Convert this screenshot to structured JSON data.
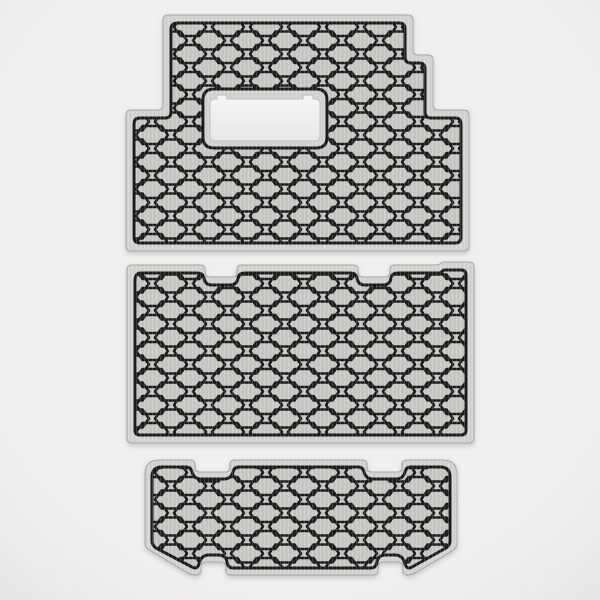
{
  "scene": {
    "type": "3d-product-render",
    "subject": "Three-piece honeycomb cargo mat liner set on a plain studio background",
    "pattern": "hexagon-honeycomb-emboss",
    "pieces": [
      {
        "name": "upper-cargo-mat",
        "description": "Large mat, stepped outline on both sides, rectangular pass-through cutout near top center"
      },
      {
        "name": "middle-cargo-mat",
        "description": "Rectangular mat with two latch notches on the top edge and a small step near the top-right corner"
      },
      {
        "name": "lower-cargo-mat",
        "description": "Short mat with two notches on the top edge, two notches on the bottom edge and chamfered lower corners"
      }
    ]
  },
  "colors": {
    "background": "#f0efed",
    "vignette": "#e7e6e4",
    "rim": "#d5d3cf",
    "rim_edge": "#a8a6a2",
    "surface": "#c9c7c2",
    "hex_line": "#1e1d1b",
    "hole_fill_top": "#f7f6f4",
    "hole_fill_bottom": "#e9e7e4",
    "hole_edge": "#c2c0bc",
    "shadow": "#6e6c68"
  }
}
